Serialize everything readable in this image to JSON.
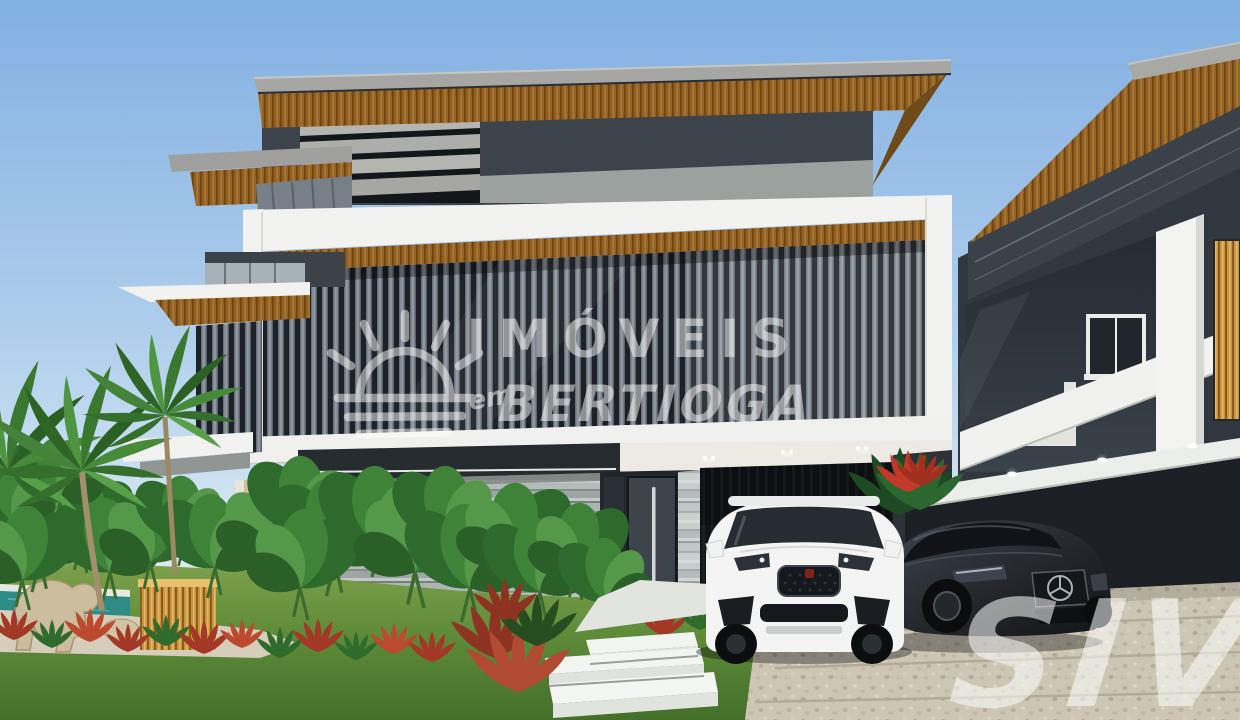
{
  "scene": {
    "description": "Photorealistic 3D architectural rendering of a modern two-storey house: charcoal vertical-louver facade wrapped by white frames, timber soffits under grey roof slabs, travertine entry wall, dark pivot door, garage with white SUV and dark sedan on a pebbled driveway, tropical garden with palms, elephant-ear plants, red foliage, pool edge, stone sculpture and floating white steps; similar neighbouring house on the right.",
    "vehicles": [
      "white-suv",
      "dark-sedan"
    ],
    "features": [
      "roof-slab-with-wood-soffit",
      "horizontal-louvers",
      "white-wrap-frame",
      "vertical-louver-facade",
      "travertine-wall",
      "entry-door",
      "garage",
      "boundary-wall-with-uplights",
      "pool-edge",
      "stone-sculpture",
      "timber-slat-box",
      "floating-steps",
      "pebble-driveway",
      "neighbor-house",
      "palm-trees",
      "elephant-ear-bed",
      "red-foliage-row",
      "lawn"
    ]
  },
  "watermark": {
    "icon": "sunrise-over-water-icon",
    "line1": "IMÓVEIS",
    "prefix": "em",
    "line2": "BERTIOGA",
    "color": "#ffffff"
  },
  "corner_mark": {
    "text": "SIV",
    "color": "#ffffff"
  },
  "palette": {
    "sky_top": "#82b0e2",
    "sky_horizon": "#edf5f7",
    "charcoal_wall": "#343b42",
    "louver_gap": "#1d2228",
    "louver_slat": "#9aa2ab",
    "wood_soffit": "#925f23",
    "white_trim": "#f2f3f0",
    "travertine": "#a9b1b0",
    "grass": "#5d8a38",
    "foliage": "#2e6b2c",
    "red_plant": "#a23825",
    "pool_water": "#2f8b85",
    "driveway": "#cdc6b5",
    "car_white": "#f3f4f3",
    "car_dark": "#26292e",
    "timber_box": "#c9963f"
  }
}
